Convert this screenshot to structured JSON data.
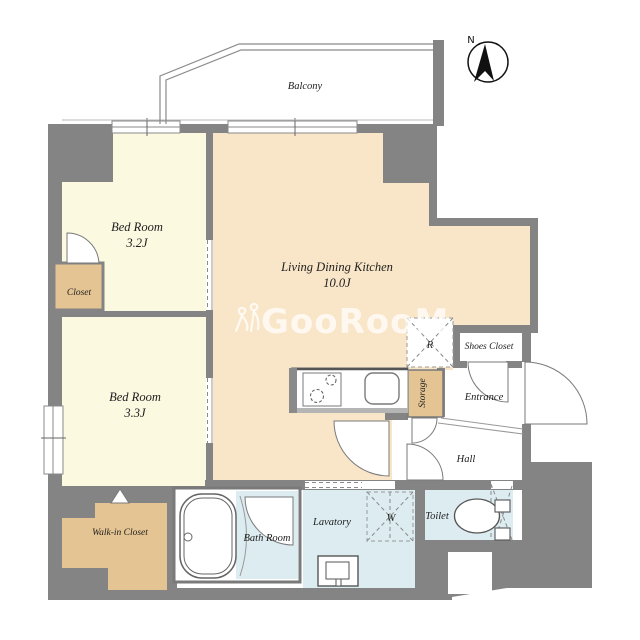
{
  "rooms": {
    "balcony": {
      "label": "Balcony"
    },
    "bedroom_a": {
      "label": "Bed Room",
      "size": "3.2J"
    },
    "bedroom_b": {
      "label": "Bed Room",
      "size": "3.3J"
    },
    "ldk": {
      "label": "Living Dining Kitchen",
      "size": "10.0J"
    },
    "closet": {
      "label": "Closet"
    },
    "walk_in_closet": {
      "label": "Walk-in Closet"
    },
    "storage": {
      "label": "Storage"
    },
    "shoes_closet": {
      "label": "Shoes Closet"
    },
    "entrance": {
      "label": "Entrance"
    },
    "hall": {
      "label": "Hall"
    },
    "bath": {
      "label": "Bath Room"
    },
    "lavatory": {
      "label": "Lavatory"
    },
    "toilet": {
      "label": "Toilet"
    }
  },
  "fixtures": {
    "refrigerator_label": "R",
    "washer_label": "W"
  },
  "compass": {
    "north_label": "N"
  },
  "watermark": {
    "text": "GooRooM"
  },
  "colors": {
    "wall": "#848484",
    "ldk_floor": "#f9e6c8",
    "bedroom_floor": "#fcf9e1",
    "closet_floor": "#e5c493",
    "wet_area_floor": "#dcecf1",
    "line": "#888888",
    "label_text": "#1d1d1d",
    "watermark": "rgba(255,255,255,0.72)"
  }
}
